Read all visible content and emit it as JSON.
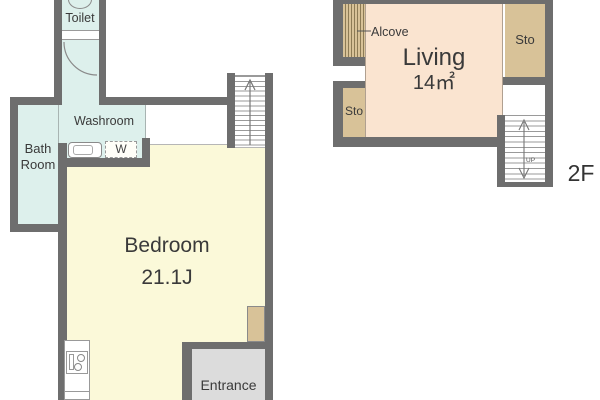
{
  "floor_1": {
    "toilet": "Toilet",
    "washroom": "Washroom",
    "bath_line1": "Bath",
    "bath_line2": "Room",
    "washer": "W",
    "room_name": "Bedroom",
    "room_size": "21.1J",
    "entrance": "Entrance"
  },
  "floor_2": {
    "alcove": "Alcove",
    "room_name": "Living",
    "room_size": "14㎡",
    "storage_upper": "Sto",
    "storage_lower": "Sto",
    "stairs_direction": "UP",
    "floor_label": "2F"
  },
  "colors": {
    "wall": "#6e6e6e",
    "water_rooms": "#ddf0ec",
    "bedroom": "#fbf9d9",
    "living": "#fae4d0",
    "storage": "#d8c298",
    "entrance": "#dcdcdc",
    "background": "#ffffff",
    "text": "#3a3a3a"
  }
}
